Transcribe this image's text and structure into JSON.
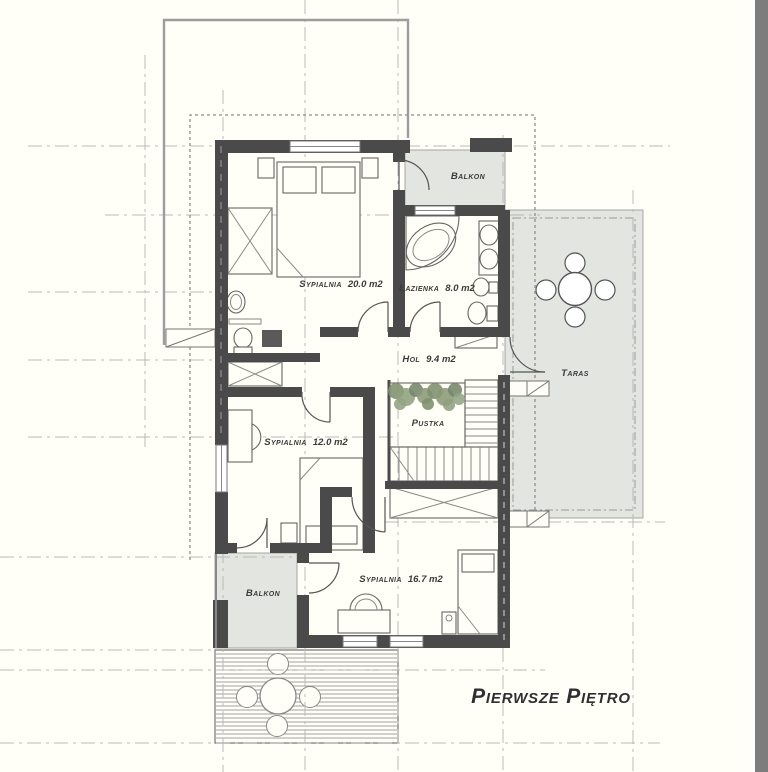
{
  "title": "Pierwsze Piętro",
  "rooms": {
    "balkon_top": {
      "name": "Balkon",
      "area": ""
    },
    "sypialnia_20": {
      "name": "Sypialnia",
      "area": "20.0 m2"
    },
    "lazienka": {
      "name": "Łazienka",
      "area": "8.0 m2"
    },
    "hol": {
      "name": "Hol",
      "area": "9.4 m2"
    },
    "taras": {
      "name": "Taras",
      "area": ""
    },
    "pustka": {
      "name": "Pustka",
      "area": ""
    },
    "sypialnia_12": {
      "name": "Sypialnia",
      "area": "12.0 m2"
    },
    "sypialnia_16": {
      "name": "Sypialnia",
      "area": "16.7 m2"
    },
    "balkon_bottom": {
      "name": "Balkon",
      "area": ""
    }
  },
  "colors": {
    "wall": "#4a4a4a",
    "outdoor_fill": "#e3e5e0",
    "grid_line": "#b9b9b9",
    "background": "#fffef7",
    "edge_strip": "#7d7d7d"
  }
}
